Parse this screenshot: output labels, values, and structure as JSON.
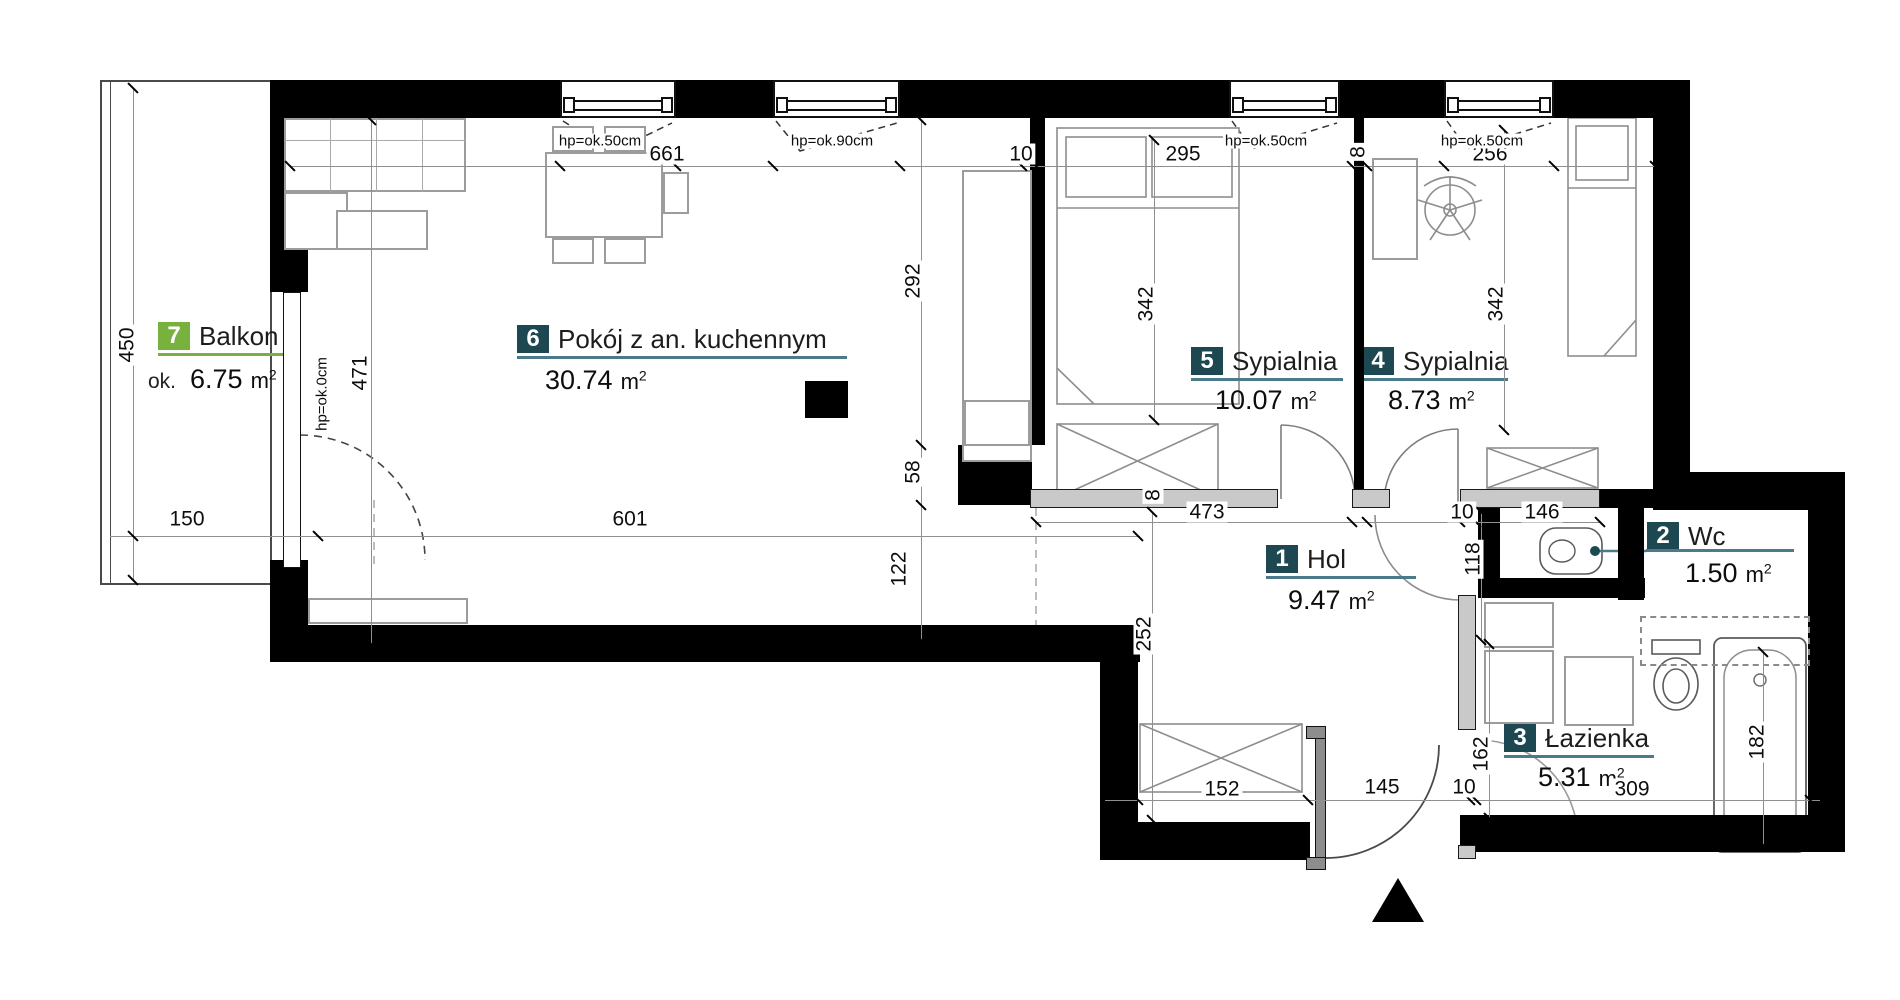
{
  "plan": {
    "rooms": [
      {
        "number": "7",
        "name": "Balkon",
        "area_prefix": "ok.",
        "area": "6.75",
        "unit": "m",
        "unit_sup": "2",
        "box_color": "#78b13e"
      },
      {
        "number": "6",
        "name": "Pokój z an. kuchennym",
        "area": "30.74",
        "unit": "m",
        "unit_sup": "2",
        "box_color": "#1d4852"
      },
      {
        "number": "5",
        "name": "Sypialnia",
        "area": "10.07",
        "unit": "m",
        "unit_sup": "2",
        "box_color": "#1d4852"
      },
      {
        "number": "4",
        "name": "Sypialnia",
        "area": "8.73",
        "unit": "m",
        "unit_sup": "2",
        "box_color": "#1d4852"
      },
      {
        "number": "1",
        "name": "Hol",
        "area": "9.47",
        "unit": "m",
        "unit_sup": "2",
        "box_color": "#1d4852"
      },
      {
        "number": "2",
        "name": "Wc",
        "area": "1.50",
        "unit": "m",
        "unit_sup": "2",
        "box_color": "#1d4852"
      },
      {
        "number": "3",
        "name": "Łazienka",
        "area": "5.31",
        "unit": "m",
        "unit_sup": "2",
        "box_color": "#1d4852"
      }
    ],
    "dims": {
      "d450": "450",
      "d471": "471",
      "d150": "150",
      "d601": "601",
      "d661": "661",
      "d10a": "10",
      "d295": "295",
      "d8": "8",
      "d8b": "8",
      "d256": "256",
      "d292": "292",
      "d58": "58",
      "d122": "122",
      "d252": "252",
      "d342a": "342",
      "d342b": "342",
      "d473": "473",
      "d10b": "10",
      "d146": "146",
      "d118": "118",
      "d162": "162",
      "d182": "182",
      "d152": "152",
      "d145": "145",
      "d10c": "10",
      "d309": "309"
    },
    "hp": {
      "w1": "hp=ok.50cm",
      "w2": "hp=ok.90cm",
      "w3": "hp=ok.50cm",
      "w4": "hp=ok.50cm",
      "door": "hp=ok.0cm"
    },
    "colors": {
      "room_box_teal": "#1d4852",
      "balcony_box_green": "#78b13e",
      "underline_teal": "#4b7b8a",
      "underline_green": "#78b13e",
      "wall": "#000000"
    }
  }
}
